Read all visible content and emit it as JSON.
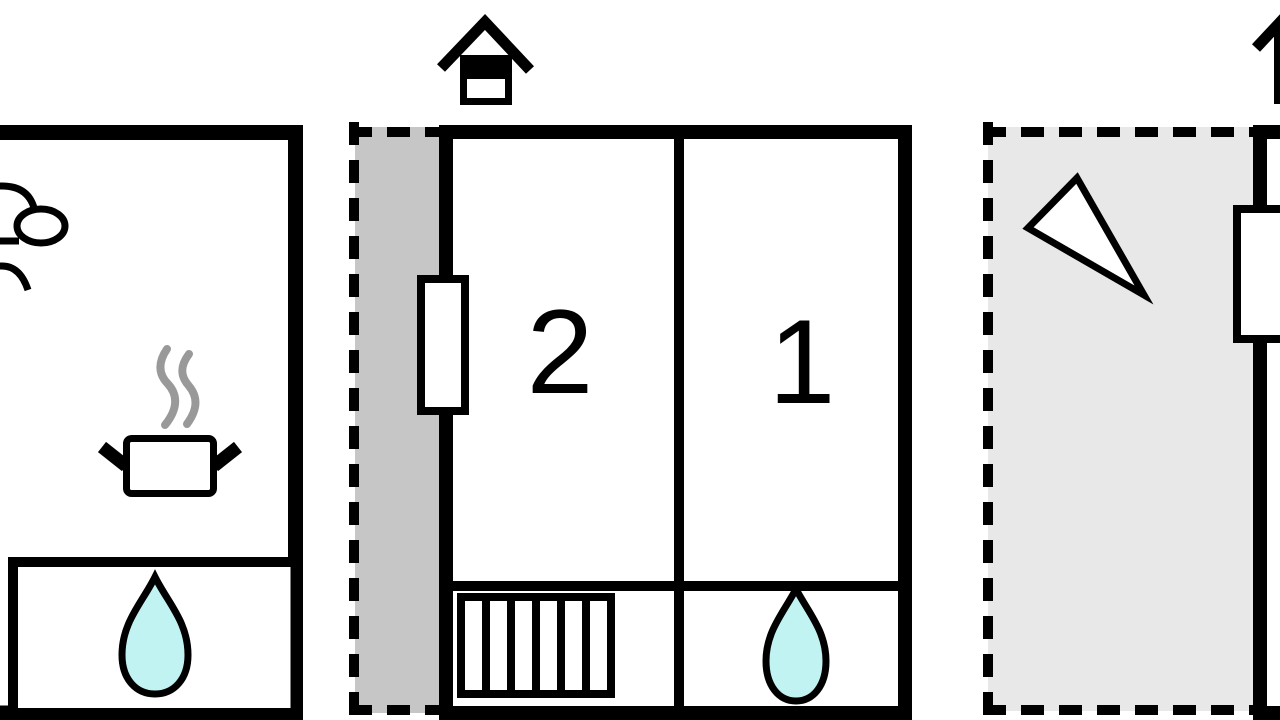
{
  "document": {
    "type": "floor-plan",
    "title": "Holiday home floor plan"
  },
  "labels": {
    "bedroom2": "2",
    "bedroom1": "1"
  },
  "colors": {
    "wall": "#000000",
    "background": "#ffffff",
    "water_drop": "#c2f3f3",
    "covered_terrace": "#c6c6c6",
    "open_terrace": "#e8e8e8",
    "steam": "#999999"
  },
  "rooms": [
    {
      "id": "left-building-room",
      "label": "",
      "features": [
        "toilet-icon",
        "cooking-pot-icon",
        "steam-icon"
      ]
    },
    {
      "id": "left-building-bathroom",
      "label": "",
      "features": [
        "water-drop-icon"
      ]
    },
    {
      "id": "bedroom-2",
      "label": "2",
      "features": [
        "window-icon",
        "stairs-icon"
      ]
    },
    {
      "id": "bedroom-1",
      "label": "1",
      "features": [
        "water-drop-icon"
      ]
    },
    {
      "id": "covered-terrace-strip",
      "label": "",
      "features": []
    },
    {
      "id": "open-terrace",
      "label": "",
      "features": [
        "triangle-icon",
        "window-icon"
      ]
    },
    {
      "id": "right-building-partial",
      "label": "",
      "features": [
        "window-icon",
        "chimney-icon-partial"
      ]
    }
  ],
  "icons": [
    "chimney-icon",
    "chimney-icon-partial",
    "toilet-icon",
    "cooking-pot-icon",
    "steam-icon",
    "water-drop-icon",
    "window-icon",
    "stairs-icon",
    "triangle-icon"
  ]
}
